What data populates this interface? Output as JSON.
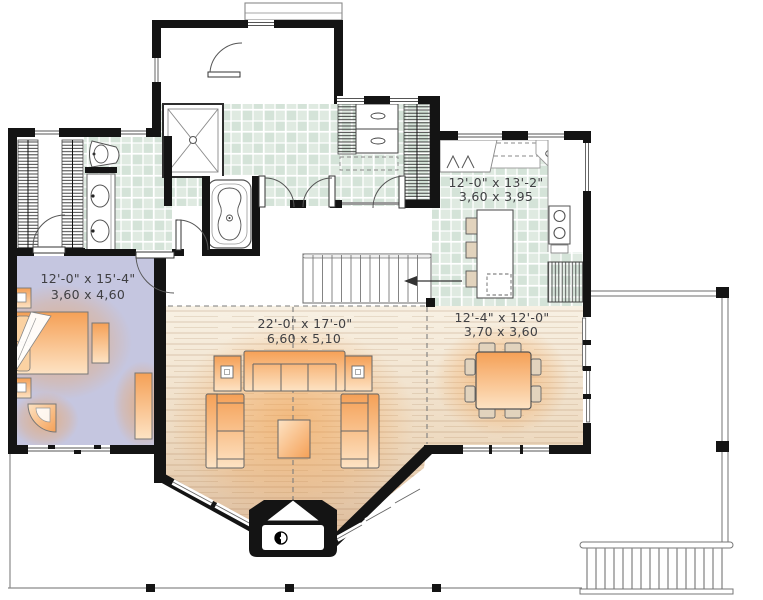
{
  "plan": {
    "title": "first-floor-plan",
    "rooms": [
      {
        "name": "bedroom",
        "imperial": "12'-0\" x 15'-4\"",
        "metric": "3,60 x 4,60"
      },
      {
        "name": "kitchen",
        "imperial": "12'-0\" x 13'-2\"",
        "metric": "3,60 x 3,95"
      },
      {
        "name": "living-room",
        "imperial": "22'-0\" x 17'-0\"",
        "metric": "6,60 x 5,10"
      },
      {
        "name": "dining-room",
        "imperial": "12'-4\" x 12'-0\"",
        "metric": "3,70 x 3,60"
      }
    ],
    "icons": {
      "stairs_direction_arrow": "left-arrow",
      "wood_stove": "circle-swirl",
      "shower_drain": "circle",
      "door_swing": "quarter-arc"
    },
    "colors": {
      "wall": "#141414",
      "tile": "#dfeae1",
      "tile_alt": "#d4e3d8",
      "bedroom_floor": "#c5c6e0",
      "wood_light": "#f8f1e4",
      "wood_dark": "#ddbb9a",
      "furniture_orange": "#f5a056",
      "furniture_light": "#fde3c4",
      "glow": "#f49b42",
      "chair_tan": "#e2d3bd",
      "line": "#555555"
    }
  }
}
